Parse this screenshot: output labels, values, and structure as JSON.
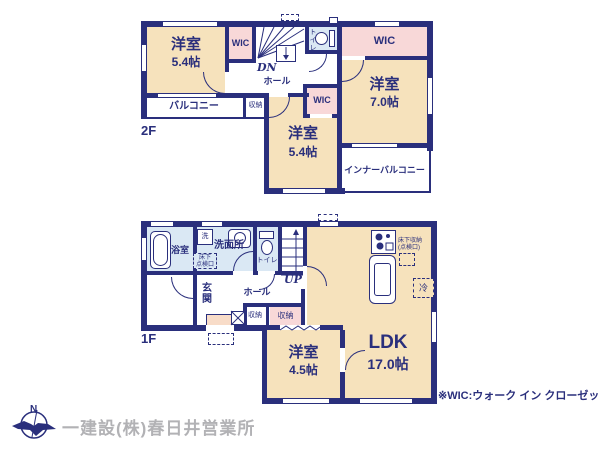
{
  "colors": {
    "wall_navy": "#2a2f7c",
    "room_beige": "#f6e2bc",
    "closet_pink": "#f8d8d8",
    "wet_area_blue": "#dae8f4",
    "entry_step_pink": "#f8dcc8",
    "company_text_gray": "#b2b2b5"
  },
  "f2": {
    "floor_label": "2F",
    "bedroom_nw": {
      "name": "洋室",
      "area": "5.4帖"
    },
    "wic_top": "WIC",
    "stairs_label": "DN",
    "hall": "ホール",
    "toilet": "トイレ",
    "wic_right": "WIC",
    "bedroom_e": {
      "name": "洋室",
      "area": "7.0帖"
    },
    "balcony": "バルコニー",
    "closet": "収納",
    "wic_mid": "WIC",
    "bedroom_s": {
      "name": "洋室",
      "area": "5.4帖"
    },
    "inner_balcony": "インナーバルコニー"
  },
  "f1": {
    "floor_label": "1F",
    "bath": "浴室",
    "laundry": "洗",
    "washroom": "洗面所",
    "underfloor_hatch_l1": "床下",
    "underfloor_hatch_l2": "点検口",
    "toilet": "トイレ",
    "stairs_label": "UP",
    "entrance": "玄関",
    "hall": "ホール",
    "closet_a": "収納",
    "closet_b": "収納",
    "bedroom": {
      "name": "洋室",
      "area": "4.5帖"
    },
    "ldk": {
      "name": "LDK",
      "area": "17.0帖"
    },
    "underfloor_storage_l1": "床下収納",
    "underfloor_storage_l2": "(点検口)",
    "fridge": "冷"
  },
  "footer": {
    "note": "※WIC:ウォーク イン クローゼット",
    "company": "一建設(株)春日井営業所",
    "compass_n": "N"
  }
}
